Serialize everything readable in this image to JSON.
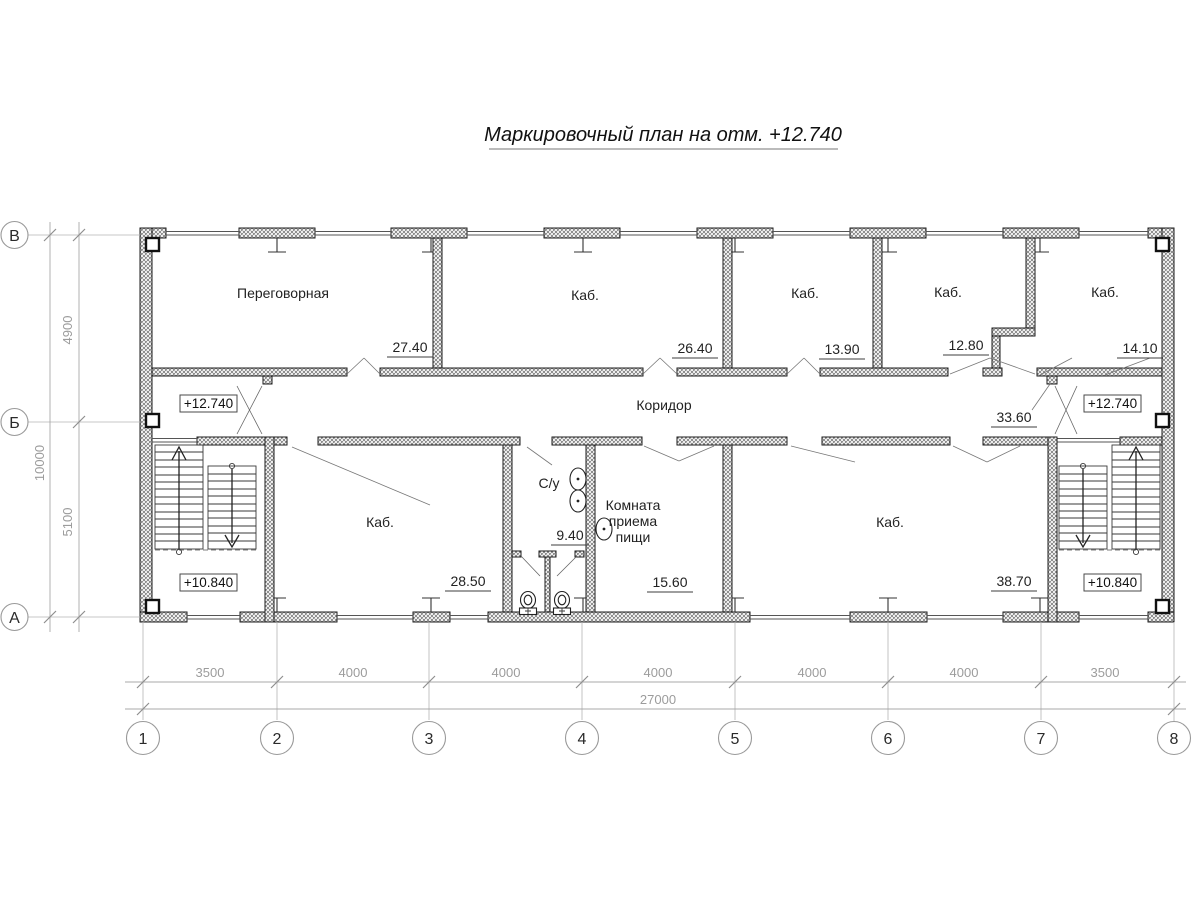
{
  "title": "Маркировочный план на отм. +12.740",
  "colors": {
    "line": "#1b1b1b",
    "dim_text": "#9c9c9c",
    "wall_hatch": "#666666",
    "background": "#ffffff"
  },
  "rooms": {
    "top": [
      {
        "name": "Переговорная",
        "area": "27.40"
      },
      {
        "name": "Каб.",
        "area": "26.40"
      },
      {
        "name": "Каб.",
        "area": "13.90"
      },
      {
        "name": "Каб.",
        "area": "12.80"
      },
      {
        "name": "Каб.",
        "area": "14.10"
      }
    ],
    "corridor": {
      "name": "Коридор",
      "area": "33.60"
    },
    "bottom": [
      {
        "name": "Каб.",
        "area": "28.50"
      },
      {
        "name": "С/у",
        "area": "9.40"
      },
      {
        "name": "Комната приема пищи",
        "area": "15.60",
        "lines": [
          "Комната",
          "приема",
          "пищи"
        ]
      },
      {
        "name": "Каб.",
        "area": "38.70"
      }
    ]
  },
  "elevations": {
    "current": "+12.740",
    "below": "+10.840"
  },
  "grid": {
    "columns": [
      "1",
      "2",
      "3",
      "4",
      "5",
      "6",
      "7",
      "8"
    ],
    "rows": [
      "В",
      "Б",
      "А"
    ]
  },
  "dimensions": {
    "bottom_spans": [
      "3500",
      "4000",
      "4000",
      "4000",
      "4000",
      "4000",
      "3500"
    ],
    "bottom_total": "27000",
    "left_spans": [
      "4900",
      "5100"
    ],
    "left_total": "10000"
  }
}
